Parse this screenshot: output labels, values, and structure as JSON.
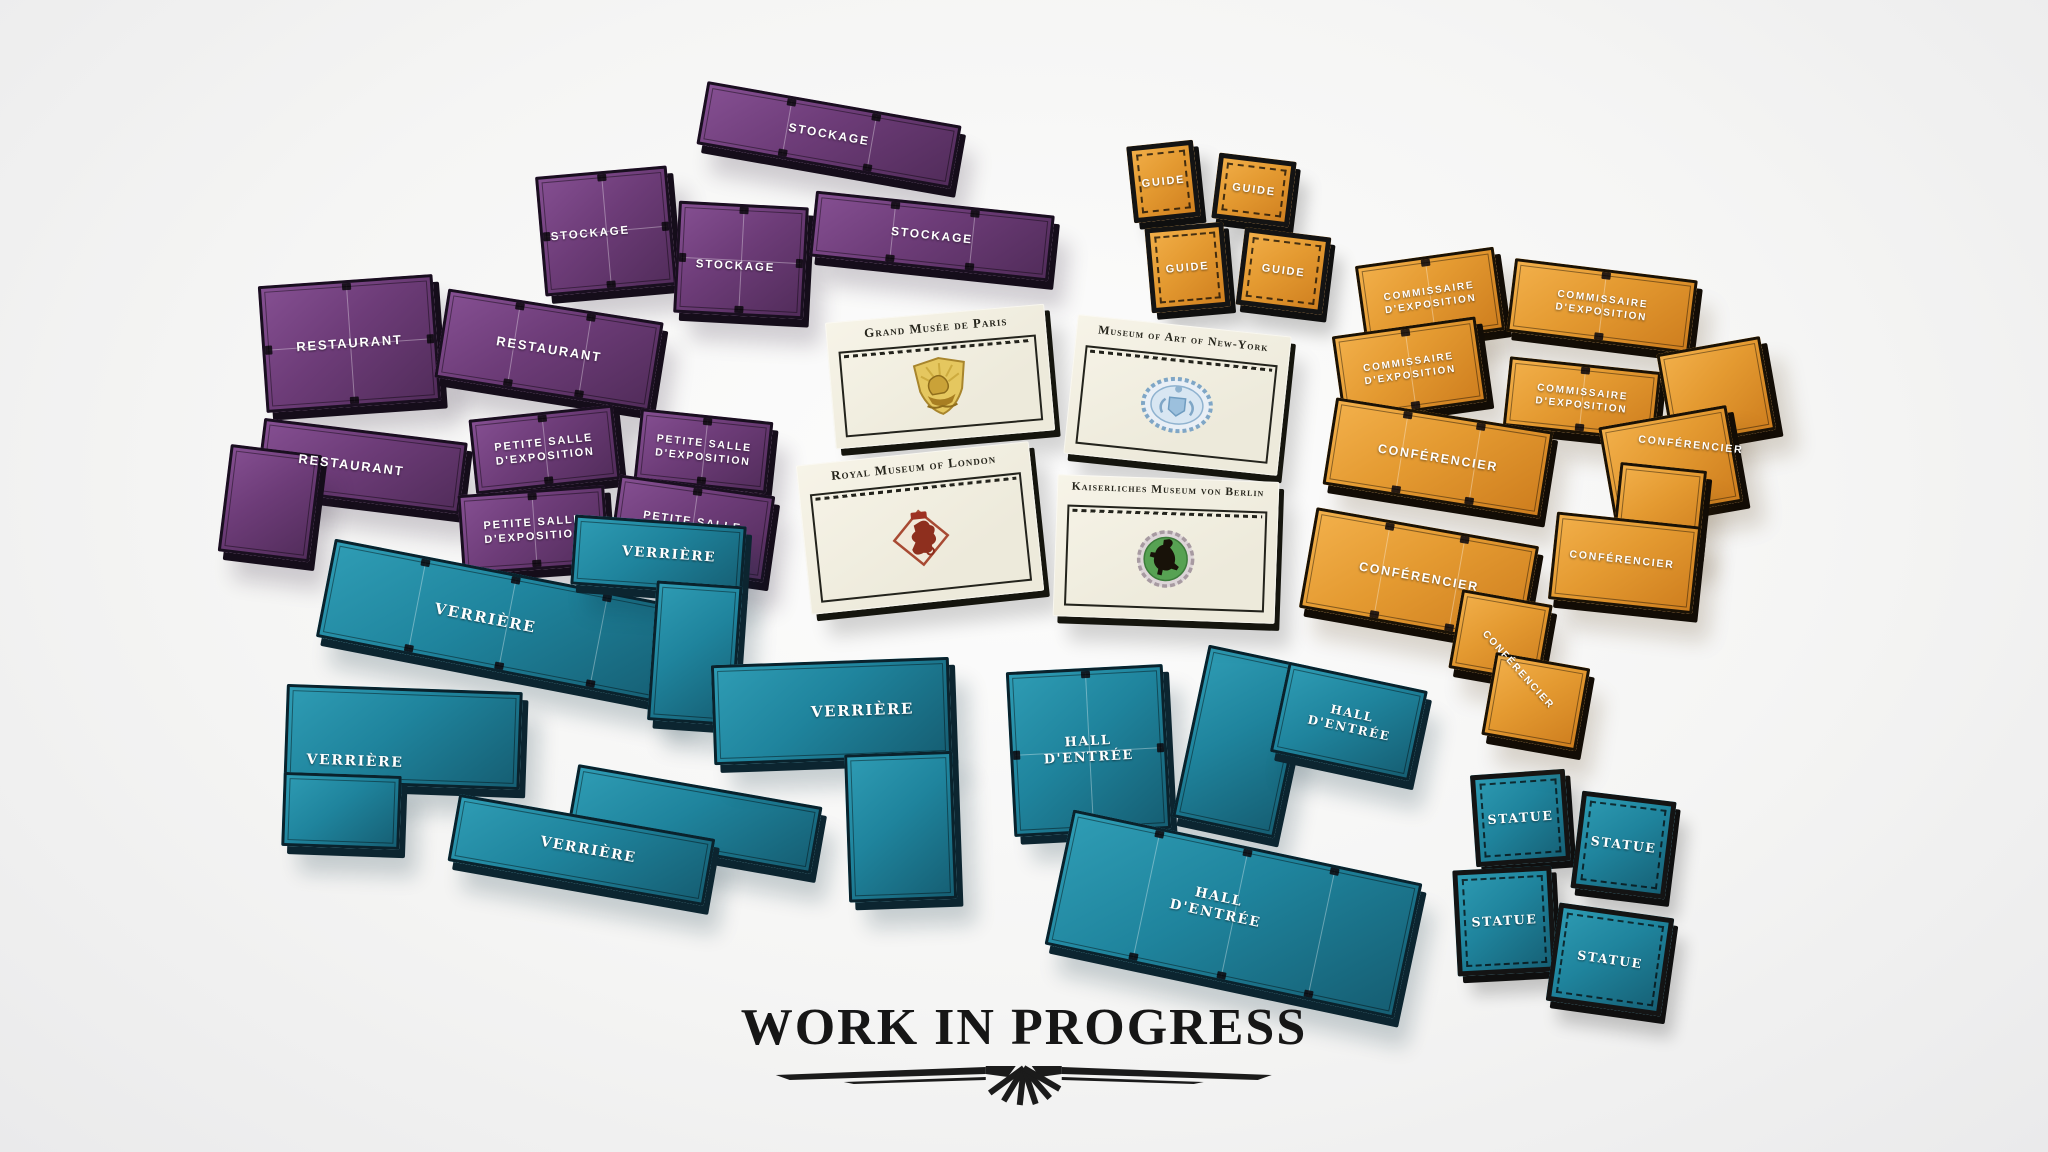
{
  "scene": {
    "width": 2048,
    "height": 1152
  },
  "palette": {
    "background": "#f3f3f2",
    "purple": "#6d3c78",
    "purple_hi": "#865093",
    "purple_lo": "#532d5c",
    "teal": "#1f849d",
    "teal_hi": "#2f9db5",
    "teal_lo": "#166075",
    "orange": "#e49a31",
    "orange_hi": "#f3b14c",
    "orange_lo": "#cf7f1f",
    "card": "#f2efe2",
    "ink": "#26251c",
    "wip": "#161616",
    "tile_text": "#ffffff"
  },
  "footer": {
    "title": "WORK IN PROGRESS"
  },
  "tiles": [
    {
      "name": "tile-stockage-bar-1",
      "label": "STOCKAGE",
      "color": "purple",
      "x": 700,
      "y": 103,
      "w": 258,
      "h": 64,
      "rot": 10,
      "segs": 3,
      "fs": 12
    },
    {
      "name": "tile-stockage-square-1",
      "label": "STOCKAGE",
      "color": "purple",
      "x": 540,
      "y": 171,
      "w": 132,
      "h": 120,
      "rot": -5,
      "cross": true,
      "fs": 11.5,
      "lx": 38,
      "ly": 52
    },
    {
      "name": "tile-stockage-square-2",
      "label": "STOCKAGE",
      "color": "purple",
      "x": 676,
      "y": 204,
      "w": 130,
      "h": 112,
      "rot": 3,
      "cross": true,
      "fs": 11.5,
      "lx": 46,
      "ly": 56
    },
    {
      "name": "tile-stockage-bar-2",
      "label": "STOCKAGE",
      "color": "purple",
      "x": 812,
      "y": 203,
      "w": 240,
      "h": 66,
      "rot": 6,
      "segs": 3,
      "fs": 12
    },
    {
      "name": "tile-restaurant-square",
      "label": "RESTAURANT",
      "color": "purple",
      "x": 262,
      "y": 280,
      "w": 175,
      "h": 127,
      "rot": -4,
      "cross": true,
      "fs": 13
    },
    {
      "name": "tile-restaurant-bar",
      "label": "RESTAURANT",
      "color": "purple",
      "x": 440,
      "y": 305,
      "w": 218,
      "h": 90,
      "rot": 9,
      "segs": 3,
      "fs": 13
    },
    {
      "name": "tile-restaurant-l",
      "label": "RESTAURANT",
      "color": "purple",
      "x": 225,
      "y": 428,
      "w": 235,
      "h": 142,
      "rot": 7,
      "parts": [
        [
          30,
          0,
          205,
          72
        ],
        [
          0,
          30,
          92,
          108
        ]
      ],
      "lx": 52,
      "ly": 26,
      "fs": 13
    },
    {
      "name": "tile-petite-salle-1",
      "label": "PETITE SALLE\nD'EXPOSITION",
      "color": "purple",
      "x": 472,
      "y": 412,
      "w": 145,
      "h": 75,
      "rot": -6,
      "segs": 2,
      "fs": 11
    },
    {
      "name": "tile-petite-salle-2",
      "label": "PETITE SALLE\nD'EXPOSITION",
      "color": "purple",
      "x": 637,
      "y": 415,
      "w": 133,
      "h": 72,
      "rot": 6,
      "segs": 2,
      "fs": 10.5
    },
    {
      "name": "tile-petite-salle-3",
      "label": "PETITE SALLE\nD'EXPOSITION",
      "color": "purple",
      "x": 460,
      "y": 490,
      "w": 147,
      "h": 80,
      "rot": -4,
      "segs": 2,
      "fs": 11
    },
    {
      "name": "tile-petite-salle-4",
      "label": "PETITE SALLE\nD'EXPOSITION",
      "color": "purple",
      "x": 613,
      "y": 485,
      "w": 157,
      "h": 87,
      "rot": 8,
      "segs": 2,
      "fs": 11
    },
    {
      "name": "tile-verriere-bar-1",
      "label": "VERRIÈRE",
      "color": "teal",
      "x": 322,
      "y": 573,
      "w": 370,
      "h": 100,
      "rot": 11,
      "segs": 4,
      "fs": 15,
      "lx": 44
    },
    {
      "name": "tile-verriere-l-1",
      "label": "VERRIÈRE",
      "color": "teal",
      "x": 284,
      "y": 688,
      "w": 236,
      "h": 162,
      "rot": 2,
      "parts": [
        [
          0,
          0,
          236,
          98
        ],
        [
          0,
          88,
          118,
          74
        ]
      ],
      "lx": 30,
      "ly": 46,
      "fs": 14
    },
    {
      "name": "tile-verriere-z",
      "label": "VERRIÈRE",
      "color": "teal",
      "x": 455,
      "y": 775,
      "w": 360,
      "h": 118,
      "rot": 10,
      "parts": [
        [
          112,
          0,
          248,
          68
        ],
        [
          0,
          50,
          260,
          68
        ]
      ],
      "lx": 38,
      "ly": 70,
      "fs": 14
    },
    {
      "name": "tile-verriere-l-tall",
      "label": "VERRIÈRE",
      "color": "teal",
      "x": 560,
      "y": 520,
      "w": 180,
      "h": 200,
      "rot": 4,
      "parts": [
        [
          8,
          0,
          172,
          70
        ],
        [
          94,
          60,
          86,
          140
        ]
      ],
      "lx": 58,
      "ly": 17,
      "fs": 13.5
    },
    {
      "name": "tile-verriere-l-big",
      "label": "VERRIÈRE",
      "color": "teal",
      "x": 715,
      "y": 661,
      "w": 238,
      "h": 242,
      "rot": -2,
      "parts": [
        [
          0,
          0,
          238,
          100
        ],
        [
          130,
          94,
          108,
          148
        ]
      ],
      "lx": 63,
      "ly": 21,
      "fs": 15
    },
    {
      "name": "tile-hall-entree-square",
      "label": "HALL\nD'ENTRÉE",
      "color": "teal",
      "x": 1010,
      "y": 668,
      "w": 157,
      "h": 165,
      "rot": -3,
      "cross": true,
      "fs": 13
    },
    {
      "name": "tile-hall-entree-l",
      "label": "HALL\nD'ENTRÉE",
      "color": "teal",
      "x": 1188,
      "y": 666,
      "w": 224,
      "h": 176,
      "rot": 12,
      "parts": [
        [
          0,
          0,
          104,
          176
        ],
        [
          82,
          0,
          142,
          92
        ]
      ],
      "lx": 69,
      "ly": 26,
      "fs": 12
    },
    {
      "name": "tile-hall-entree-bar",
      "label": "HALL\nD'ENTRÉE",
      "color": "teal",
      "x": 1055,
      "y": 845,
      "w": 357,
      "h": 138,
      "rot": 12,
      "segs": 4,
      "fs": 13.5,
      "lx": 45,
      "ly": 47
    },
    {
      "name": "tile-statue-1",
      "label": "STATUE",
      "color": "teal",
      "x": 1473,
      "y": 772,
      "w": 95,
      "h": 92,
      "rot": -4,
      "small": true,
      "fs": 12.5
    },
    {
      "name": "tile-statue-2",
      "label": "STATUE",
      "color": "teal",
      "x": 1576,
      "y": 796,
      "w": 95,
      "h": 98,
      "rot": 7,
      "small": true,
      "fs": 12.5
    },
    {
      "name": "tile-statue-3",
      "label": "STATUE",
      "color": "teal",
      "x": 1455,
      "y": 868,
      "w": 99,
      "h": 106,
      "rot": -3,
      "small": true,
      "fs": 12.5
    },
    {
      "name": "tile-statue-4",
      "label": "STATUE",
      "color": "teal",
      "x": 1552,
      "y": 910,
      "w": 116,
      "h": 99,
      "rot": 8,
      "small": true,
      "fs": 12.5
    },
    {
      "name": "tile-guide-1",
      "label": "GUIDE",
      "color": "orange",
      "x": 1130,
      "y": 143,
      "w": 67,
      "h": 77,
      "rot": -6,
      "small": true,
      "fs": 11
    },
    {
      "name": "tile-guide-2",
      "label": "GUIDE",
      "color": "orange",
      "x": 1215,
      "y": 157,
      "w": 78,
      "h": 66,
      "rot": 7,
      "small": true,
      "fs": 11
    },
    {
      "name": "tile-guide-3",
      "label": "GUIDE",
      "color": "orange",
      "x": 1148,
      "y": 225,
      "w": 79,
      "h": 85,
      "rot": -5,
      "small": true,
      "fs": 11
    },
    {
      "name": "tile-guide-4",
      "label": "GUIDE",
      "color": "orange",
      "x": 1240,
      "y": 232,
      "w": 87,
      "h": 78,
      "rot": 7,
      "small": true,
      "fs": 11
    },
    {
      "name": "tile-commissaire-1",
      "label": "COMMISSAIRE\nD'EXPOSITION",
      "color": "orange",
      "x": 1360,
      "y": 256,
      "w": 140,
      "h": 84,
      "rot": -8,
      "segs": 2,
      "fs": 10
    },
    {
      "name": "tile-commissaire-2",
      "label": "COMMISSAIRE\nD'EXPOSITION",
      "color": "orange",
      "x": 1510,
      "y": 269,
      "w": 184,
      "h": 74,
      "rot": 7,
      "segs": 2,
      "fs": 10
    },
    {
      "name": "tile-commissaire-3",
      "label": "COMMISSAIRE\nD'EXPOSITION",
      "color": "orange",
      "x": 1337,
      "y": 326,
      "w": 145,
      "h": 86,
      "rot": -8,
      "segs": 2,
      "fs": 10
    },
    {
      "name": "tile-commissaire-4",
      "label": "COMMISSAIRE\nD'EXPOSITION",
      "color": "orange",
      "x": 1506,
      "y": 364,
      "w": 152,
      "h": 70,
      "rot": 6,
      "segs": 2,
      "fs": 10
    },
    {
      "name": "tile-conferencier-bar-1",
      "label": "CONFÉRENCIER",
      "color": "orange",
      "x": 1328,
      "y": 414,
      "w": 220,
      "h": 88,
      "rot": 9,
      "segs": 3,
      "fs": 12.5
    },
    {
      "name": "tile-conferencier-bar-2",
      "label": "CONFÉRENCIER",
      "color": "orange",
      "x": 1306,
      "y": 526,
      "w": 226,
      "h": 102,
      "rot": 10,
      "segs": 3,
      "fs": 12.5
    },
    {
      "name": "tile-conferencier-l-1",
      "label": "CONFÉRENCIER",
      "color": "orange",
      "x": 1600,
      "y": 350,
      "w": 175,
      "h": 160,
      "rot": -10,
      "parts": [
        [
          70,
          0,
          105,
          95
        ],
        [
          0,
          62,
          130,
          98
        ]
      ],
      "lx": 50,
      "ly": 60,
      "lrot": 16,
      "fs": 10.5
    },
    {
      "name": "tile-conferencier-l-2",
      "label": "CONFÉRENCIER",
      "color": "orange",
      "x": 1555,
      "y": 463,
      "w": 145,
      "h": 144,
      "rot": 6,
      "parts": [
        [
          58,
          0,
          87,
          84
        ],
        [
          0,
          56,
          145,
          88
        ]
      ],
      "lx": 48,
      "ly": 68,
      "fs": 10.5
    },
    {
      "name": "tile-conferencier-step",
      "label": "CONFÉRENCIER",
      "color": "orange",
      "x": 1445,
      "y": 600,
      "w": 145,
      "h": 140,
      "rot": 10,
      "parts": [
        [
          4,
          0,
          92,
          80
        ],
        [
          48,
          56,
          96,
          84
        ]
      ],
      "lx": 50,
      "ly": 50,
      "lrot": 38,
      "fs": 10
    }
  ],
  "cards": [
    {
      "name": "card-grand-musee-de-paris",
      "title": "Grand Musée de Paris",
      "emblem": "paris-crest",
      "x": 830,
      "y": 313,
      "w": 220,
      "h": 127,
      "rot": -5,
      "fs": 13
    },
    {
      "name": "card-museum-of-art-of-new-york",
      "title": "Museum of Art of New-York",
      "emblem": "new-york-seal",
      "x": 1070,
      "y": 325,
      "w": 215,
      "h": 140,
      "rot": 6,
      "fs": 12
    },
    {
      "name": "card-royal-museum-of-london",
      "title": "Royal Museum of London",
      "emblem": "london-dragon",
      "x": 803,
      "y": 453,
      "w": 234,
      "h": 150,
      "rot": -6,
      "fs": 13
    },
    {
      "name": "card-kaiserliches-museum-von-berlin",
      "title": "Kaiserliches Museum von Berlin",
      "emblem": "berlin-bear",
      "x": 1055,
      "y": 478,
      "w": 222,
      "h": 142,
      "rot": 2,
      "fs": 11.5
    }
  ]
}
